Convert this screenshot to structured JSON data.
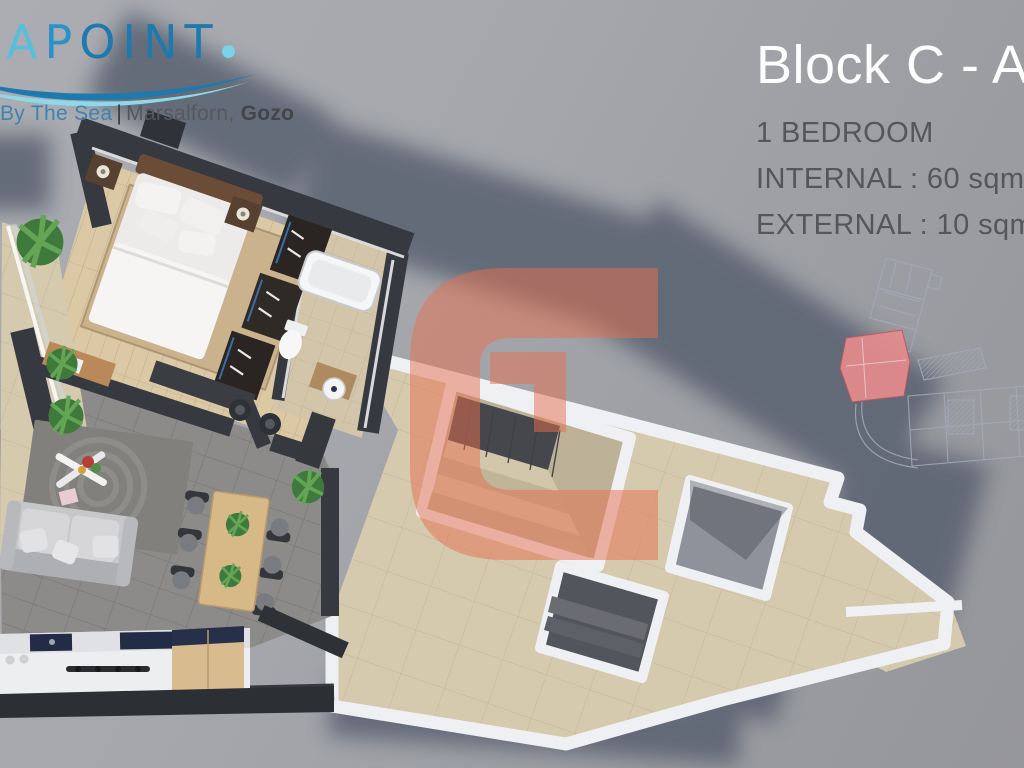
{
  "brand": {
    "letters": [
      {
        "ch": "E",
        "color": "#58bedc"
      },
      {
        "ch": "A",
        "color": "#58bedc"
      },
      {
        "ch": "P",
        "color": "#2a92c8"
      },
      {
        "ch": "O",
        "color": "#1e79ad"
      },
      {
        "ch": "I",
        "color": "#1e79ad"
      },
      {
        "ch": "N",
        "color": "#1e79ad"
      },
      {
        "ch": "T",
        "color": "#1e79ad"
      }
    ],
    "dot_color": "#7ad2e6",
    "wave_dark": "#1e79ad",
    "wave_light": "#8fd8ea",
    "tagline": {
      "by_the_sea": "By The Sea",
      "separator": "|",
      "location": "Marsalforn,",
      "location_bold": "Gozo"
    }
  },
  "unit_info": {
    "title": "Block C - A",
    "line1": "1 BEDROOM",
    "line2": "INTERNAL : 60 sqm",
    "line3": "EXTERNAL : 10 sqm"
  },
  "watermark": {
    "shape": "letter-C-logo",
    "color": "#e7704f",
    "opacity": 0.5
  },
  "site_key_plan": {
    "highlight_color": "#e58b8d",
    "line_color": "#a3a8ba"
  },
  "floorplan": {
    "rooms": [
      "bedroom",
      "bathroom",
      "hallway",
      "living-dining",
      "kitchen",
      "balcony",
      "terrace",
      "stairwell"
    ],
    "furniture": [
      "double-bed",
      "nightstands",
      "wardrobe",
      "bathtub",
      "toilet",
      "washbasin",
      "bench",
      "sofa",
      "rug",
      "coffee-table",
      "dining-table",
      "dining-chairs",
      "kitchen-counter",
      "kitchen-island",
      "plants",
      "outdoor-stairs"
    ]
  },
  "palette": {
    "background": "#a2a4a9",
    "walls": "#36393f",
    "terrace_tiles": "#d5c9ae",
    "wood_floor": "#dbc9a6",
    "pavers": "#8c8b89",
    "parapet_white": "#eff0f3",
    "shadow": "#59606f"
  }
}
